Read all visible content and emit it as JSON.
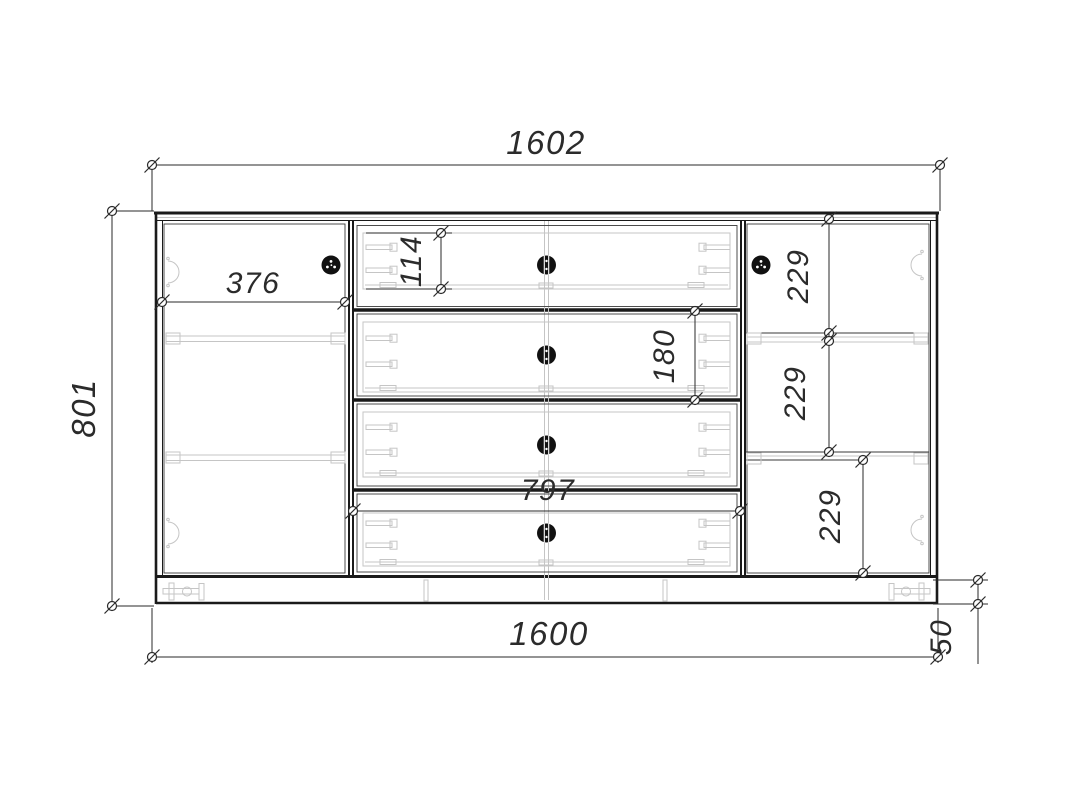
{
  "drawing": {
    "type": "furniture-front-elevation",
    "dimensions": {
      "overall_width_top": "1602",
      "overall_height_left": "801",
      "overall_width_bottom": "1600",
      "left_door_width": "376",
      "top_drawer_box_height": "114",
      "second_drawer_front_height": "180",
      "right_gap_top": "229",
      "right_gap_middle": "229",
      "right_gap_bottom": "229",
      "drawer_section_width": "797",
      "plinth_height": "50"
    },
    "colors": {
      "outline": "#1a1a1a",
      "detail_lines": "#c5c5c5",
      "dimension_text": "#2b2b2b",
      "background": "#ffffff",
      "knob": "#111111"
    }
  }
}
